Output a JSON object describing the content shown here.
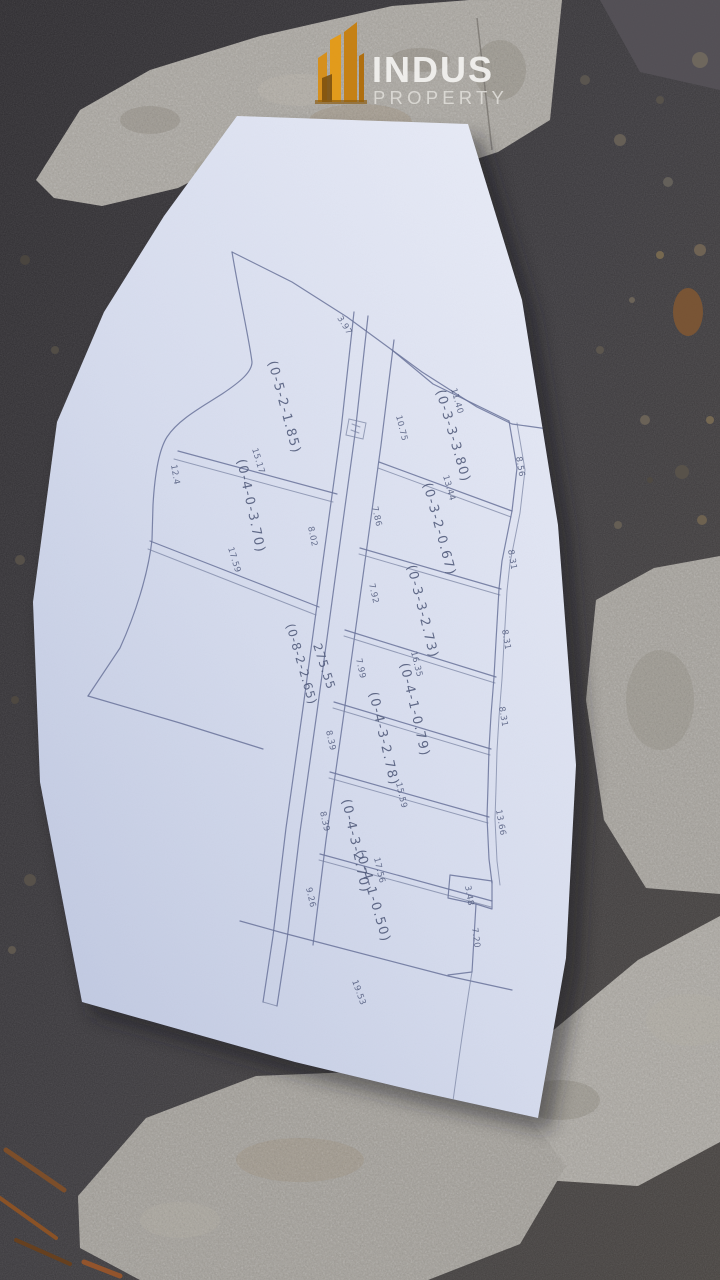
{
  "brand": {
    "name": "INDUS",
    "tagline": "PROPERTY"
  },
  "survey_map": {
    "top_edge_width": "3.97",
    "road": {
      "length": "275.55",
      "code": "(0-8-2-2.65)"
    },
    "left_plots": [
      {
        "code": "(0-5-2-1.85)",
        "bottom": "15.17",
        "left": "12.4"
      },
      {
        "code": "(0-4-0-3.70)",
        "bottom": "17.59",
        "road_side": "8.02"
      }
    ],
    "right_plots": [
      {
        "code": "(0-3-3-3.80)",
        "top": "11.40",
        "road_side": "10.75",
        "bottom": "13.44",
        "outer": "8.56"
      },
      {
        "code": "(0-3-2-0.67)",
        "road_side": "7.86",
        "outer": "8.31"
      },
      {
        "code": "(0-3-3-2.73)",
        "road_side": "7.92",
        "bottom": "16.35",
        "outer": "8.31"
      },
      {
        "code": "(0-4-1-0.79)",
        "road_side": "7.99",
        "outer": "8.31"
      },
      {
        "code": "(0-4-3-2.78)",
        "road_side": "8.39",
        "bottom": "15.59",
        "outer": "13.66"
      },
      {
        "code": "(0-4-3-2.70)",
        "road_side": "8.39",
        "bottom": "17.56"
      },
      {
        "code": "(0-4-1-0.50)",
        "road_side": "9.26",
        "bottom": "19.53",
        "outer": "7.20",
        "corner": "3.48"
      }
    ]
  }
}
